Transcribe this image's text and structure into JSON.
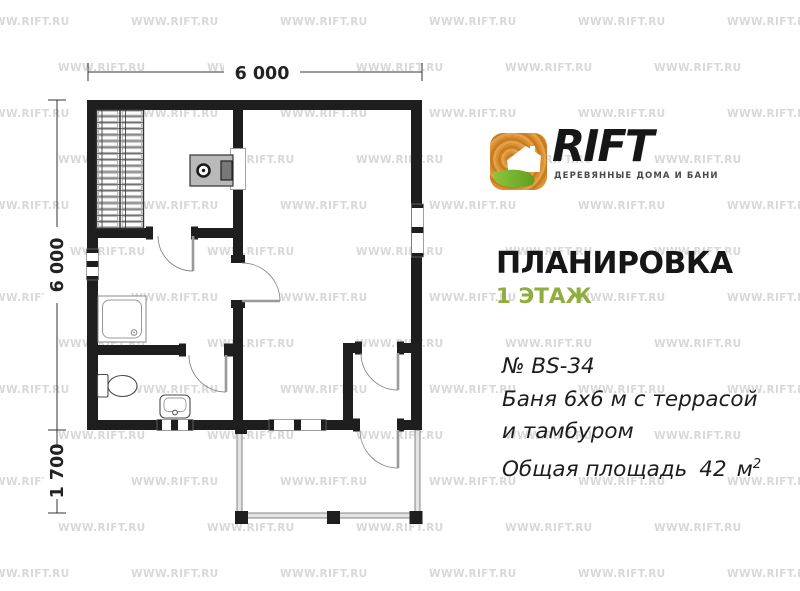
{
  "watermark": {
    "text": "WWW.RIFT.RU",
    "color": "#d8d8d8"
  },
  "brand": {
    "name": "RIFT",
    "tagline": "ДЕРЕВЯННЫЕ ДОМА И БАНИ",
    "logo_colors": {
      "wood": "#d98f33",
      "wood_dark": "#c87d1f",
      "leaf": "#6fae2a"
    }
  },
  "heading": {
    "title": "ПЛАНИРОВКА",
    "floor": "1 ЭТАЖ",
    "floor_color": "#8fae3e"
  },
  "description": {
    "project_no": "№ BS-34",
    "line1": "Баня 6х6 м с террасой",
    "line2": "и тамбуром",
    "area_label": "Общая площадь",
    "area_value": "42",
    "area_unit": "м",
    "area_sup": "2"
  },
  "plan": {
    "dim_top": "6 000",
    "dim_left": "6 000",
    "dim_left_bottom": "1 700"
  }
}
